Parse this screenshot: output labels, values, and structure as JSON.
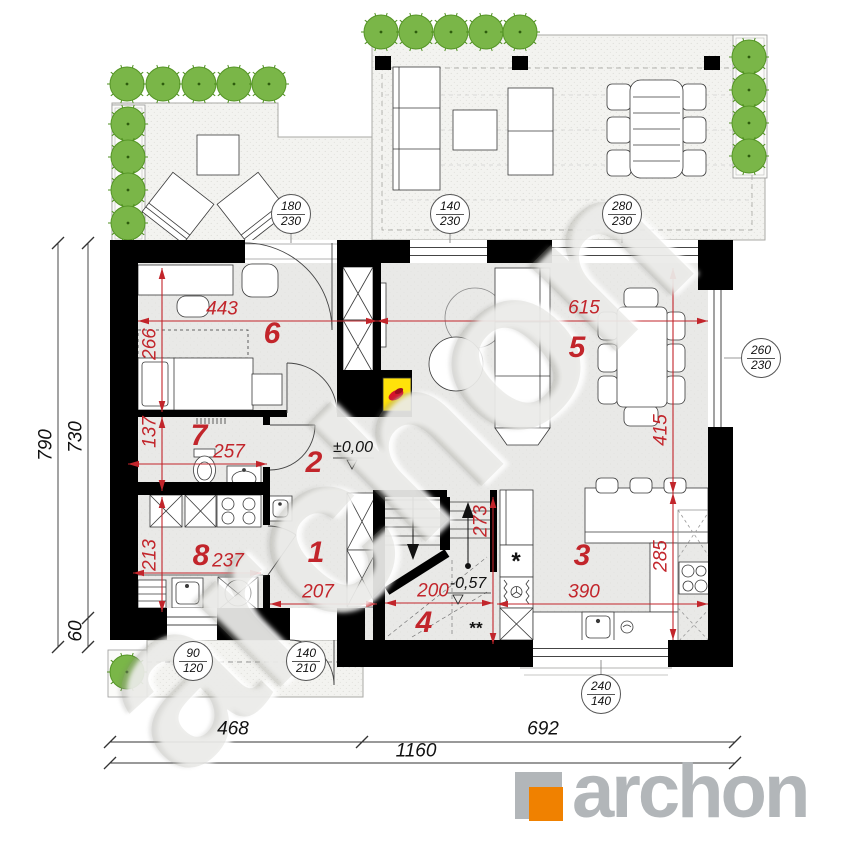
{
  "plan": {
    "rooms": {
      "r1": "1",
      "r2": "2",
      "r3": "3",
      "r4": "4",
      "r5": "5",
      "r6": "6",
      "r7": "7",
      "r8": "8"
    },
    "dims": {
      "d443": "443",
      "d615": "615",
      "d266": "266",
      "d137": "137",
      "d257": "257",
      "d213": "213",
      "d237": "237",
      "d207": "207",
      "d200": "200",
      "d273": "273",
      "d390": "390",
      "d285": "285",
      "d415": "415"
    },
    "levels": {
      "ground": "±0,00",
      "landing": "-0,57"
    },
    "openings": {
      "o180_230": {
        "w": "180",
        "h": "230"
      },
      "o140_230": {
        "w": "140",
        "h": "230"
      },
      "o280_230": {
        "w": "280",
        "h": "230"
      },
      "o260_230": {
        "w": "260",
        "h": "230"
      },
      "o90_120": {
        "w": "90",
        "h": "120"
      },
      "o140_210": {
        "w": "140",
        "h": "210"
      },
      "o240_140": {
        "w": "240",
        "h": "140"
      }
    },
    "exterior_dims": {
      "left_total": "790",
      "left_main": "730",
      "left_step": "60",
      "bottom_left": "468",
      "bottom_right": "692",
      "bottom_total": "1160"
    },
    "notes": {
      "single": "*",
      "double": "**"
    }
  },
  "watermark": {
    "text": "archon"
  },
  "logo": {
    "brand": "archon"
  },
  "colors": {
    "dimension_red": "#c2252b",
    "wall_black": "#000000",
    "tree_green": "#7ab648",
    "fireplace_yellow": "#ffe20a",
    "flame_red": "#d6152c",
    "logo_gray": "#b2b6b9",
    "logo_orange": "#f08100"
  }
}
